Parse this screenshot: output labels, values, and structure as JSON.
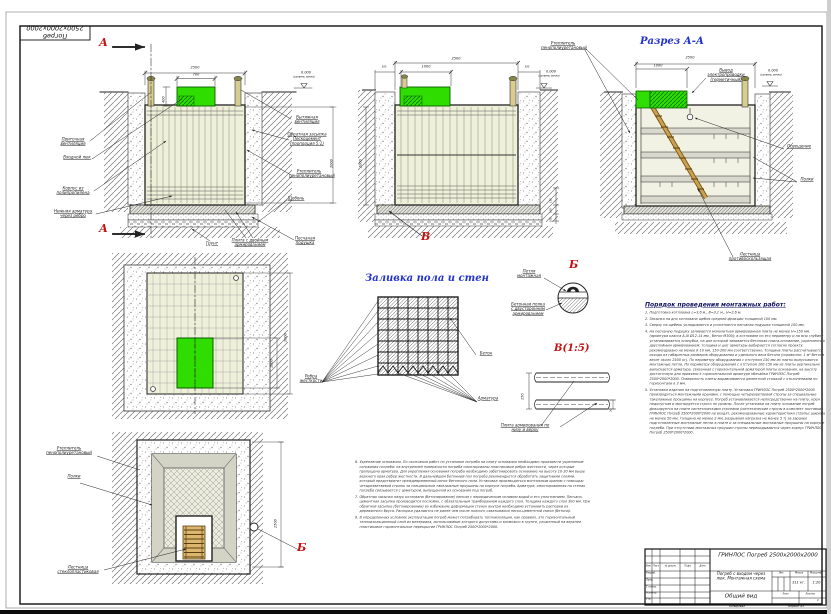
{
  "palette": {
    "green": "#2fdd00",
    "title_blue": "#2233cc",
    "marker_red": "#c41212"
  },
  "frame": {
    "stamp_text": "Погреб 2500x2000x2000",
    "footer_copy": "Копировал",
    "footer_format": "Формат А3"
  },
  "view_section_main": {
    "marker_top": "А",
    "marker_bottom": "А",
    "dim_width": "2500",
    "dim_hatch": "700",
    "dim_hatch_h": "400",
    "dim_depth": "2000",
    "level": "0.000",
    "level_note": "(уровень земли)",
    "label_supply_vent": "Приточная вентиляция",
    "label_entry_hatch": "Входной люк",
    "label_body": "Корпус из полипропилена",
    "label_bottom_rebar": "Нижняя арматура через ребро",
    "label_exhaust_vent": "Вытяжная вентиляция",
    "label_backfill": "Обратная засыпка Пескоцемент (пропорция 5:1)",
    "label_insulation": "Утеплитель пенополиуретановый",
    "label_gravel": "Щебень",
    "label_sand": "Песчаная подушка",
    "label_soil": "Грунт",
    "label_slab": "Плита с двойным армированием"
  },
  "view_section_b": {
    "marker": "В",
    "dim_width": "2500",
    "dim_lid": "1000",
    "dim_left": "300",
    "dim_right": "300",
    "dim_height": "2000",
    "dim_150": "150",
    "dim_100a": "100",
    "dim_100b": "100",
    "level": "0.000",
    "level_note": "(уровень земли)"
  },
  "view_section_aa": {
    "title": "Разрез А-А",
    "dim_width": "2500",
    "dim_lid": "1000",
    "level": "0.000",
    "level_note": "(уровень земли)",
    "label_insulation": "Утеплитель пенополиуретановый",
    "label_wiring": "Вывод электропроводки (герметичный)",
    "label_light": "Освещение",
    "label_shelves": "Полки",
    "label_ladder": "Лестница противоскользящая"
  },
  "view_plan_top": {
    "dim_height": "2000",
    "dim_hatch": "1000",
    "label_ribs": "Ребра жесткости"
  },
  "view_pour": {
    "title": "Заливка пола и стен",
    "label_concrete": "Бетон",
    "label_rebar": "Арматура"
  },
  "detail_b": {
    "title": "Б",
    "label_loop": "Петля монтажная",
    "label_shelf": "Бетонная полка с двусторонним армированием"
  },
  "detail_v": {
    "title": "В(1:5)",
    "dim_150": "150",
    "dim_30": "30",
    "label_plate": "Плита армирования по низу и верху"
  },
  "view_plan_bottom": {
    "marker": "Б",
    "dim_height": "2500",
    "label_insulation": "Утеплитель пенополиуретановый",
    "label_shelves": "Полки",
    "label_ladder": "Лестница стеклопластиковая"
  },
  "procedure": {
    "title": "Порядок проведения монтажных работ:",
    "items": [
      {
        "num": "1.",
        "text": "Подготовка котлована L=3,6 м., В=3,1 м., Н=2,6 м."
      },
      {
        "num": "2.",
        "text": "Засыпка на дно котлована щебня средней фракции толщиной 100 мм."
      },
      {
        "num": "3.",
        "text": "Сверху на щебень укладывается и уплотняется песчаная подушка толщиной 100 мм."
      },
      {
        "num": "4.",
        "text": "На песчаную подушку заливается монолитная армированная плита не менее Н=150 мм. (арматура класса А-III Ø12-14 мм., бетон М300); в котловане по его периметру и на всю глубину устанавливается опалубка, на дне которой заливается бетонная плита-основание, укрепленная двуслойным армированием; толщина и шаг арматуры выбирается согласно проекту, рекомендовано не менее 8-10 мм, 150-200 мм соответственно. Толщина плиты рассчитывается исходя из габаритных размеров оборудования и удельного веса бетона (справочно: 1 м³ бетона весит около 2500 кг). По периметру оборудования с отступом 150 мм из плиты выпускаются монтажные петли. По периметру оборудования с отступом 100-150 мм из плиты вертикально выпускается арматура, связанная с горизонтальной арматурой плиты основания, на высоту достаточную для привязки к горизонтальной арматуре обечайки ГРИНЛОС Погреб 2500*2000*2000. Поверхность плиты выравнивается цементной стяжкой с отклонениями по горизонтали в 3 мм."
      },
      {
        "num": "5.",
        "text": "Установка изделия на подготовленную плиту. Установка ГРИНЛОС Погреб 2500*2000*2000 производиться монтажными кранами, с помощью четырехветвевой стропы за специальные такелажные проушины на корпусе. Погреб устанавливается непосредственно на плиту, крен недопустим и монтируется строго по уровню. После установки на плиту основание погреб фиксируется на плите синтетическими стропами (синтетические стропы в комплект поставки ГРИНЛОС Погреб 2500*2000*2000 не входят, рекомендованные характеристики стропы: ширина не менее 50 мм, толщина не менее 2 мм, разрывная нагрузка не менее 5 т) за заранее подготовленные монтажные петли в плите и за специальные монтажные проушины на корпусе погреба. При отсутствии монтажных проушин стропы перекидываются через корпус ГРИНЛОС Погреб 2500*2000*2000."
      }
    ],
    "items2": [
      {
        "num": "6.",
        "text": "Укрепление основания. По окончании работ по установке погреба на плиту основания необходимо произвести укрепление основания погреба: на внутренней поверхности погреба смонтированы пластиковые ребра жесткости, через которые пропущена арматура. Для укрепления основания погреба необходимо забетонировать основание на высоту 10-20 мм выше верхнего края ребер жесткости. В дальнейшем бетонный пол погреба рекомендуется обработать защитными слоями, который предотвратит преждевременный износ бетонного пола. Установка производиться монтажным краном с помощью четырехветвевой стропы за специальные такелажные проушины на корпусе погреба. Арматура, смонтированная на стенах погреба связывается с арматурой, выпущенной из основания под погреб."
      },
      {
        "num": "7.",
        "text": "Обратная засыпка пазух котлована (бетонирование) песком с периодическим поливом водой и его уплотнением. Песчано-цементная засыпка производится послойно, с обязательным трамбованием каждого слоя. Толщина каждого слоя 300 мм. При обратной засыпке (бетонировании) во избежание деформации стенок внутри необходимо установить распорки из деревянного бруса. Распорки удаляются не ранее чем после полного схватывания песко-цементной смеси (бетона)."
      },
      {
        "num": "8.",
        "text": "В определенных условиях эксплуатации погреб может потребовать теплоизоляции, как правило, это горизонтальный теплоизоляционный слой из материала, использование которого допустимо и возможно в грунте, уложенный на верхнее пластиковое горизонтальное перекрытие ГРИНЛОС Погреб 2500*2000*2000."
      }
    ]
  },
  "titleblock": {
    "product": "ГРИНЛОС Погреб 2500x2000x2000",
    "doc_title": "Погреб с входом через люк. Монтажная схема",
    "view_name": "Общий вид",
    "h_lit": "Лит.",
    "h_mass": "Масса",
    "h_scale": "Масштаб",
    "mass": "311 кг.",
    "scale": "1:20",
    "h_sheet": "Лист",
    "h_sheets": "Листов",
    "sheets": "1",
    "col_izm": "Изм.",
    "col_list": "Лист",
    "col_doc": "№ докум.",
    "col_sign": "Подп.",
    "col_date": "Дата",
    "role_1": "Разраб.",
    "role_2": "Пров.",
    "role_3": "Т.контр.",
    "role_4": "Н.контр.",
    "role_5": "Утв."
  }
}
